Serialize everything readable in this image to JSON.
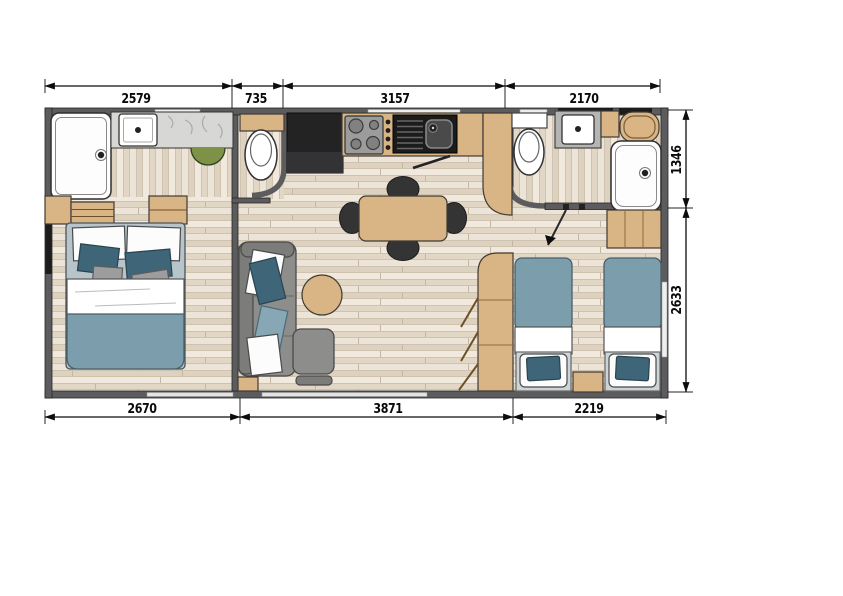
{
  "dims": {
    "top": [
      {
        "label": "2579"
      },
      {
        "label": "735"
      },
      {
        "label": "3157"
      },
      {
        "label": "2170"
      }
    ],
    "bottom": [
      {
        "label": "2670"
      },
      {
        "label": "3871"
      },
      {
        "label": "2219"
      }
    ],
    "right": [
      {
        "label": "1346"
      },
      {
        "label": "2633"
      }
    ]
  },
  "icons": {
    "shower": "shower-tray-icon",
    "toilet": "toilet-icon",
    "sink": "sink-icon",
    "stove": "stove-burners-icon",
    "bed": "bed-icon",
    "sofa": "sofa-icon",
    "table": "dining-table-icon",
    "door": "door-swing-icon"
  },
  "colors": {
    "wall": "#5c5c5e",
    "floor": "#e9e0d3",
    "wood": "#d9b586",
    "blanket": "#7b9dac",
    "navy": "#3f6579",
    "bedbase": "#b7c4ca",
    "headboard": "#cdd4d7",
    "sofa": "#8d8d8b",
    "chair": "#343434",
    "green": "#7d9247",
    "black_counter": "#232323",
    "marble": "#d7d7d5",
    "dim": "#0d0d0d"
  }
}
